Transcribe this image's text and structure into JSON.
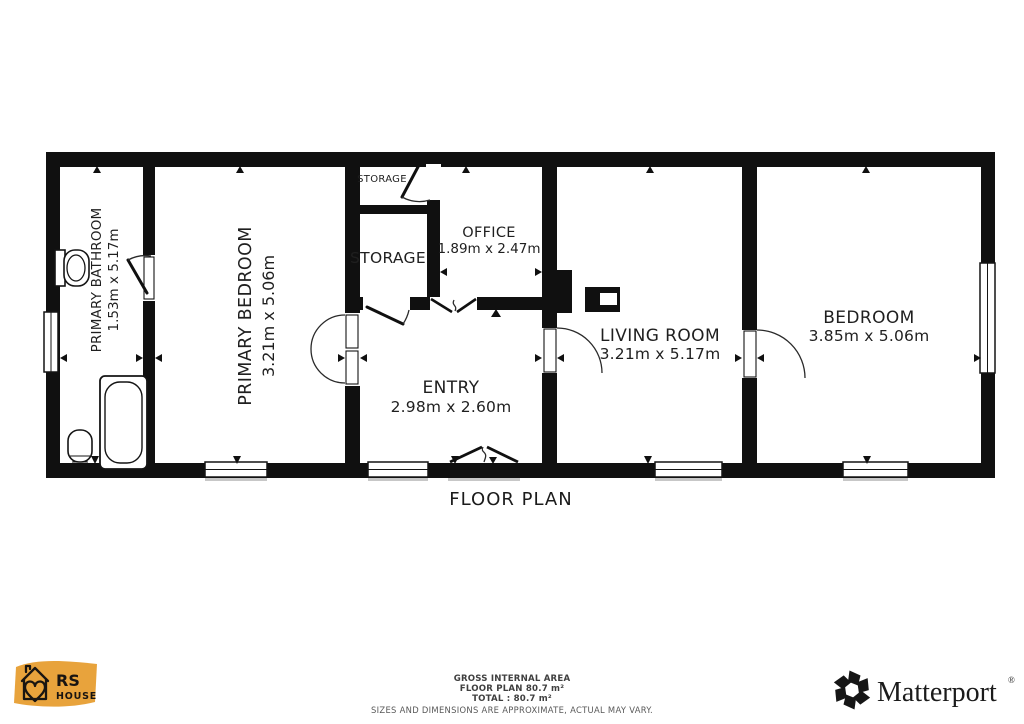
{
  "plan": {
    "title": "FLOOR PLAN",
    "rooms": [
      {
        "name": "PRIMARY BATHROOM",
        "dims": "1.53m x 5.17m"
      },
      {
        "name": "PRIMARY BEDROOM",
        "dims": "3.21m x 5.06m"
      },
      {
        "name": "STORAGE"
      },
      {
        "name": "STORAGE"
      },
      {
        "name": "OFFICE",
        "dims": "1.89m x 2.47m"
      },
      {
        "name": "ENTRY",
        "dims": "2.98m x 2.60m"
      },
      {
        "name": "LIVING ROOM",
        "dims": "3.21m x 5.17m"
      },
      {
        "name": "BEDROOM",
        "dims": "3.85m x 5.06m"
      }
    ]
  },
  "footer": {
    "area_label": "GROSS INTERNAL AREA",
    "floor_plan_area": "FLOOR PLAN 80.7 m²",
    "total_area": "TOTAL :  80.7 m²",
    "disclaimer": "SIZES AND DIMENSIONS ARE APPROXIMATE, ACTUAL MAY VARY."
  },
  "logos": {
    "rs_house": {
      "line1": "RS",
      "line2": "HOUSE"
    },
    "matterport": {
      "wordmark": "Matterport",
      "registered": "®"
    }
  },
  "colors": {
    "wall": "#101010",
    "background": "#ffffff",
    "rs_gold": "#e8a33c",
    "text": "#1f1f1f",
    "footer_text": "#3f3f3f"
  }
}
